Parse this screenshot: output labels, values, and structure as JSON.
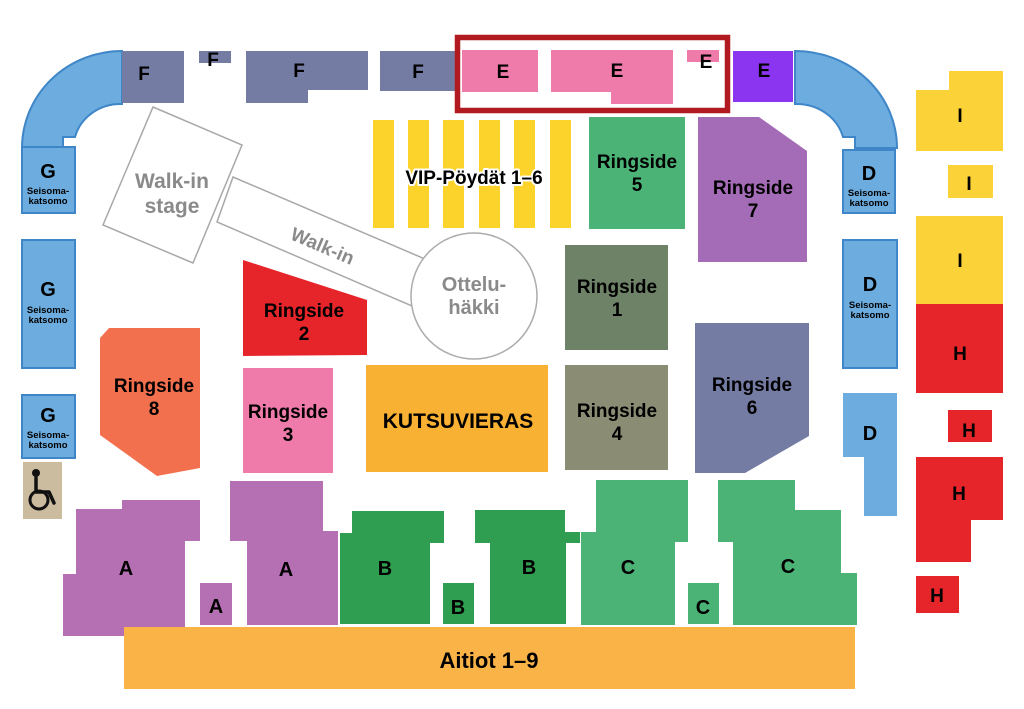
{
  "canvas": {
    "width": 1024,
    "height": 709,
    "background": "#ffffff"
  },
  "palette": {
    "standing_blue": "#6CACDE",
    "standing_blue_border": "#3E86C8",
    "slate": "#757CA4",
    "pink": "#EE7BA9",
    "violet": "#8B35F0",
    "yellow": "#FBD237",
    "vip_yellow": "#FBD32B",
    "jade": "#4CB377",
    "mauve": "#A46CB7",
    "orchid": "#B470B2",
    "red": "#E6252B",
    "coral": "#F3704E",
    "sage_dark": "#6E8268",
    "sage_grey": "#8A8C73",
    "orange": "#F8B133",
    "orange_light": "#FAB347",
    "green_dark": "#2F9E50",
    "tan": "#CBBC9F",
    "highlight_red": "#B11A21",
    "floor_grey": "#A8A8A8",
    "floor_text": "#8A8A8A"
  },
  "floor": [
    {
      "name": "walkin-corridor",
      "type": "polygon",
      "points": "233,177 432,262 419,309 217,222",
      "fill": "#ffffff",
      "stroke": "#A8A8A8",
      "stroke_width": 1.5,
      "interactable": false,
      "labels": [
        {
          "text": "Walk-in",
          "x": 320,
          "y": 252,
          "size": 19,
          "color": "#8A8A8A",
          "rotate": 23
        }
      ]
    },
    {
      "name": "walkin-stage",
      "type": "polygon",
      "points": "153,107 242,145 193,263 103,225",
      "fill": "#ffffff",
      "stroke": "#A8A8A8",
      "stroke_width": 1.5,
      "interactable": false,
      "labels": [
        {
          "lines": [
            "Walk-in",
            "stage"
          ],
          "x": 172,
          "y": 188,
          "lh": 25,
          "size": 21,
          "color": "#8A8A8A"
        }
      ]
    },
    {
      "name": "ottelu-cage",
      "type": "circle",
      "cx": 474,
      "cy": 296,
      "r": 63,
      "fill": "#ffffff",
      "stroke": "#ACACAC",
      "stroke_width": 1.5,
      "interactable": false,
      "labels": [
        {
          "lines": [
            "Ottelu-",
            "häkki"
          ],
          "x": 474,
          "y": 291,
          "lh": 23,
          "size": 20,
          "color": "#8A8A8A"
        }
      ]
    }
  ],
  "vip": {
    "name": "vip-tables",
    "stripe_xs": [
      373,
      408,
      443,
      479,
      514,
      550
    ],
    "stripe_y": 120,
    "stripe_w": 21,
    "stripe_h": 108,
    "fill": "#FBD32B",
    "label": {
      "text": "VIP-Pöydät 1–6",
      "x": 474,
      "y": 184,
      "size": 19,
      "color": "#000000",
      "halo": "#ffffff"
    }
  },
  "wheelchair": {
    "name": "wheelchair-area",
    "x": 23,
    "y": 462,
    "w": 39,
    "h": 57,
    "fill": "#CBBC9F",
    "icon": "wheelchair-icon"
  },
  "highlight": {
    "name": "highlight-box-e-sections",
    "x": 457.5,
    "y": 37.5,
    "w": 270,
    "h": 73,
    "stroke": "#B11A21",
    "stroke_width": 5.5
  },
  "sections": [
    {
      "name": "arc-left",
      "type": "path",
      "d": "M 122,51 A 100,97 0 0 0 22,148 L 63,148 L 63,137 L 75,137 A 47,44 0 0 1 122,104 Z",
      "fill": "#6CACDE",
      "stroke": "#3E86C8",
      "stroke_width": 2,
      "interactable": true,
      "labels": []
    },
    {
      "name": "arc-right",
      "type": "path",
      "d": "M 795,51 A 102,97 0 0 1 897,148 L 855,148 L 855,137 L 843,137 A 48,44 0 0 0 795,104 Z",
      "fill": "#6CACDE",
      "stroke": "#3E86C8",
      "stroke_width": 2,
      "interactable": true,
      "labels": []
    },
    {
      "name": "section-f-1",
      "type": "rect",
      "x": 122,
      "y": 51,
      "w": 62,
      "h": 52,
      "fill": "#757CA4",
      "interactable": true,
      "labels": [
        {
          "text": "F",
          "x": 144,
          "y": 80,
          "size": 19
        }
      ]
    },
    {
      "name": "section-f-2",
      "type": "rect",
      "x": 199,
      "y": 51,
      "w": 32,
      "h": 12,
      "fill": "#757CA4",
      "interactable": true,
      "labels": [
        {
          "text": "F",
          "x": 213,
          "y": 66,
          "size": 19
        }
      ]
    },
    {
      "name": "section-f-3",
      "type": "polygon",
      "points": "246,51 368,51 368,90 308,90 308,103 246,103",
      "fill": "#757CA4",
      "interactable": true,
      "labels": [
        {
          "text": "F",
          "x": 299,
          "y": 77,
          "size": 19
        }
      ]
    },
    {
      "name": "section-f-4",
      "type": "rect",
      "x": 380,
      "y": 51,
      "w": 77,
      "h": 40,
      "fill": "#757CA4",
      "interactable": true,
      "labels": [
        {
          "text": "F",
          "x": 418,
          "y": 78,
          "size": 19
        }
      ]
    },
    {
      "name": "section-e-1",
      "type": "rect",
      "x": 462,
      "y": 50,
      "w": 76,
      "h": 42,
      "fill": "#EE7BA9",
      "interactable": true,
      "labels": [
        {
          "text": "E",
          "x": 503,
          "y": 78,
          "size": 19
        }
      ]
    },
    {
      "name": "section-e-2",
      "type": "polygon",
      "points": "551,50 673,50 673,104 611,104 611,92 551,92",
      "fill": "#EE7BA9",
      "interactable": true,
      "labels": [
        {
          "text": "E",
          "x": 617,
          "y": 77,
          "size": 19
        }
      ]
    },
    {
      "name": "section-e-3",
      "type": "rect",
      "x": 687,
      "y": 50,
      "w": 32,
      "h": 12,
      "fill": "#EE7BA9",
      "interactable": true,
      "labels": [
        {
          "text": "E",
          "x": 706,
          "y": 68,
          "size": 19
        }
      ]
    },
    {
      "name": "section-e-4",
      "type": "rect",
      "x": 733,
      "y": 51,
      "w": 60,
      "h": 51,
      "fill": "#8B35F0",
      "interactable": true,
      "labels": [
        {
          "text": "E",
          "x": 764,
          "y": 77,
          "size": 19
        }
      ]
    },
    {
      "name": "section-g-1",
      "type": "rect",
      "x": 22,
      "y": 147,
      "w": 53,
      "h": 66,
      "fill": "#6CACDE",
      "stroke": "#3E86C8",
      "stroke_width": 2,
      "interactable": true,
      "labels": [
        {
          "text": "G",
          "x": 48,
          "y": 178,
          "size": 20
        },
        {
          "lines": [
            "Seisoma-",
            "katsomo"
          ],
          "x": 48,
          "y": 194,
          "lh": 10,
          "size": 9.5
        }
      ]
    },
    {
      "name": "section-g-2",
      "type": "rect",
      "x": 22,
      "y": 240,
      "w": 53,
      "h": 128,
      "fill": "#6CACDE",
      "stroke": "#3E86C8",
      "stroke_width": 2,
      "interactable": true,
      "labels": [
        {
          "text": "G",
          "x": 48,
          "y": 296,
          "size": 20
        },
        {
          "lines": [
            "Seisoma-",
            "katsomo"
          ],
          "x": 48,
          "y": 313,
          "lh": 10,
          "size": 9.5
        }
      ]
    },
    {
      "name": "section-g-3",
      "type": "rect",
      "x": 22,
      "y": 395,
      "w": 53,
      "h": 63,
      "fill": "#6CACDE",
      "stroke": "#3E86C8",
      "stroke_width": 2,
      "interactable": true,
      "labels": [
        {
          "text": "G",
          "x": 48,
          "y": 422,
          "size": 20
        },
        {
          "lines": [
            "Seisoma-",
            "katsomo"
          ],
          "x": 48,
          "y": 438,
          "lh": 10,
          "size": 9.5
        }
      ]
    },
    {
      "name": "section-d-1",
      "type": "rect",
      "x": 843,
      "y": 150,
      "w": 52,
      "h": 63,
      "fill": "#6CACDE",
      "stroke": "#3E86C8",
      "stroke_width": 2,
      "interactable": true,
      "labels": [
        {
          "text": "D",
          "x": 869,
          "y": 180,
          "size": 20
        },
        {
          "lines": [
            "Seisoma-",
            "katsomo"
          ],
          "x": 869,
          "y": 196,
          "lh": 10,
          "size": 9.5
        }
      ]
    },
    {
      "name": "section-d-2",
      "type": "rect",
      "x": 843,
      "y": 240,
      "w": 54,
      "h": 128,
      "fill": "#6CACDE",
      "stroke": "#3E86C8",
      "stroke_width": 2,
      "interactable": true,
      "labels": [
        {
          "text": "D",
          "x": 870,
          "y": 291,
          "size": 20
        },
        {
          "lines": [
            "Seisoma-",
            "katsomo"
          ],
          "x": 870,
          "y": 308,
          "lh": 10,
          "size": 9.5
        }
      ]
    },
    {
      "name": "section-d-3",
      "type": "polygon",
      "points": "843,393 897,393 897,516 864,516 864,457 843,457",
      "fill": "#6CACDE",
      "interactable": true,
      "labels": [
        {
          "text": "D",
          "x": 870,
          "y": 440,
          "size": 20
        }
      ]
    },
    {
      "name": "section-i-1",
      "type": "polygon",
      "points": "916,90 949,90 949,71 1003,71 1003,151 916,151",
      "fill": "#FBD237",
      "interactable": true,
      "labels": [
        {
          "text": "I",
          "x": 960,
          "y": 122,
          "size": 19
        }
      ]
    },
    {
      "name": "section-i-2",
      "type": "rect",
      "x": 948,
      "y": 165,
      "w": 45,
      "h": 33,
      "fill": "#FBD237",
      "interactable": true,
      "labels": [
        {
          "text": "I",
          "x": 969,
          "y": 190,
          "size": 19
        }
      ]
    },
    {
      "name": "section-i-3",
      "type": "rect",
      "x": 916,
      "y": 216,
      "w": 87,
      "h": 88,
      "fill": "#FBD237",
      "interactable": true,
      "labels": [
        {
          "text": "I",
          "x": 960,
          "y": 267,
          "size": 19
        }
      ]
    },
    {
      "name": "section-h-1",
      "type": "rect",
      "x": 916,
      "y": 304,
      "w": 87,
      "h": 89,
      "fill": "#E6252B",
      "interactable": true,
      "labels": [
        {
          "text": "H",
          "x": 960,
          "y": 360,
          "size": 19
        }
      ]
    },
    {
      "name": "section-h-2",
      "type": "rect",
      "x": 948,
      "y": 410,
      "w": 44,
      "h": 32,
      "fill": "#E6252B",
      "interactable": true,
      "labels": [
        {
          "text": "H",
          "x": 969,
          "y": 437,
          "size": 19
        }
      ]
    },
    {
      "name": "section-h-3",
      "type": "polygon",
      "points": "916,457 1003,457 1003,520 971,520 971,562 916,562",
      "fill": "#E6252B",
      "interactable": true,
      "labels": [
        {
          "text": "H",
          "x": 959,
          "y": 500,
          "size": 19
        }
      ]
    },
    {
      "name": "section-h-4",
      "type": "rect",
      "x": 916,
      "y": 576,
      "w": 43,
      "h": 37,
      "fill": "#E6252B",
      "interactable": true,
      "labels": [
        {
          "text": "H",
          "x": 937,
          "y": 602,
          "size": 19
        }
      ]
    },
    {
      "name": "section-ringside-5",
      "type": "rect",
      "x": 589,
      "y": 117,
      "w": 96,
      "h": 112,
      "fill": "#4CB377",
      "interactable": true,
      "labels": [
        {
          "lines": [
            "Ringside",
            "5"
          ],
          "x": 637,
          "y": 168,
          "lh": 23,
          "size": 19
        }
      ]
    },
    {
      "name": "section-ringside-7",
      "type": "polygon",
      "points": "698,117 759,117 807,151 807,262 698,262",
      "fill": "#A46CB7",
      "interactable": true,
      "labels": [
        {
          "lines": [
            "Ringside",
            "7"
          ],
          "x": 753,
          "y": 194,
          "lh": 23,
          "size": 19
        }
      ]
    },
    {
      "name": "section-ringside-1",
      "type": "rect",
      "x": 565,
      "y": 245,
      "w": 103,
      "h": 105,
      "fill": "#6E8268",
      "interactable": true,
      "labels": [
        {
          "lines": [
            "Ringside",
            "1"
          ],
          "x": 617,
          "y": 293,
          "lh": 23,
          "size": 19
        }
      ]
    },
    {
      "name": "section-ringside-2",
      "type": "polygon",
      "points": "243,260 367,300 367,355 243,356",
      "fill": "#E6252B",
      "interactable": true,
      "labels": [
        {
          "lines": [
            "Ringside",
            "2"
          ],
          "x": 304,
          "y": 317,
          "lh": 23,
          "size": 19
        }
      ]
    },
    {
      "name": "section-ringside-3",
      "type": "rect",
      "x": 243,
      "y": 368,
      "w": 90,
      "h": 105,
      "fill": "#EE7BA9",
      "interactable": true,
      "labels": [
        {
          "lines": [
            "Ringside",
            "3"
          ],
          "x": 288,
          "y": 418,
          "lh": 23,
          "size": 19
        }
      ]
    },
    {
      "name": "section-ringside-8",
      "type": "polygon",
      "points": "109,328 200,328 200,468 157,476 100,435 100,338",
      "fill": "#F3704E",
      "interactable": true,
      "labels": [
        {
          "lines": [
            "Ringside",
            "8"
          ],
          "x": 154,
          "y": 392,
          "lh": 23,
          "size": 19
        }
      ]
    },
    {
      "name": "section-ringside-6",
      "type": "polygon",
      "points": "695,323 809,323 809,436 745,473 695,473",
      "fill": "#757CA4",
      "interactable": true,
      "labels": [
        {
          "lines": [
            "Ringside",
            "6"
          ],
          "x": 752,
          "y": 391,
          "lh": 23,
          "size": 19
        }
      ]
    },
    {
      "name": "section-ringside-4",
      "type": "rect",
      "x": 565,
      "y": 365,
      "w": 103,
      "h": 105,
      "fill": "#8A8C73",
      "interactable": true,
      "labels": [
        {
          "lines": [
            "Ringside",
            "4"
          ],
          "x": 617,
          "y": 417,
          "lh": 23,
          "size": 19
        }
      ]
    },
    {
      "name": "section-kutsuvieras",
      "type": "rect",
      "x": 366,
      "y": 365,
      "w": 182,
      "h": 107,
      "fill": "#F8B133",
      "interactable": true,
      "labels": [
        {
          "text": "KUTSUVIERAS",
          "x": 458,
          "y": 428,
          "size": 21
        }
      ]
    },
    {
      "name": "section-a-1",
      "type": "polygon",
      "points": "76,509 122,509 122,500 200,500 200,541 185,541 185,628 124,628 124,636 63,636 63,574 76,574",
      "fill": "#B470B2",
      "interactable": true,
      "labels": [
        {
          "text": "A",
          "x": 126,
          "y": 575,
          "size": 20
        }
      ]
    },
    {
      "name": "section-a-2",
      "type": "rect",
      "x": 200,
      "y": 583,
      "w": 32,
      "h": 42,
      "fill": "#B470B2",
      "interactable": true,
      "labels": [
        {
          "text": "A",
          "x": 216,
          "y": 613,
          "size": 20
        }
      ]
    },
    {
      "name": "section-a-3",
      "type": "polygon",
      "points": "230,481 323,481 323,531 338,531 338,625 247,625 247,541 230,541",
      "fill": "#B470B2",
      "interactable": true,
      "labels": [
        {
          "text": "A",
          "x": 286,
          "y": 576,
          "size": 20
        }
      ]
    },
    {
      "name": "section-b-1",
      "type": "polygon",
      "points": "340,533 352,533 352,511 444,511 444,543 430,543 430,624 340,624",
      "fill": "#2F9E50",
      "interactable": true,
      "labels": [
        {
          "text": "B",
          "x": 385,
          "y": 575,
          "size": 20
        }
      ]
    },
    {
      "name": "section-b-2",
      "type": "rect",
      "x": 443,
      "y": 583,
      "w": 31,
      "h": 41,
      "fill": "#2F9E50",
      "interactable": true,
      "labels": [
        {
          "text": "B",
          "x": 458,
          "y": 614,
          "size": 20
        }
      ]
    },
    {
      "name": "section-b-3",
      "type": "polygon",
      "points": "475,510 565,510 565,532 580,532 580,543 566,543 566,624 490,624 490,543 475,543",
      "fill": "#2F9E50",
      "interactable": true,
      "labels": [
        {
          "text": "B",
          "x": 529,
          "y": 574,
          "size": 20
        }
      ]
    },
    {
      "name": "section-c-1",
      "type": "polygon",
      "points": "596,480 688,480 688,542 675,542 675,625 581,625 581,532 596,532",
      "fill": "#4CB377",
      "interactable": true,
      "labels": [
        {
          "text": "C",
          "x": 628,
          "y": 574,
          "size": 20
        }
      ]
    },
    {
      "name": "section-c-2",
      "type": "rect",
      "x": 688,
      "y": 583,
      "w": 31,
      "h": 41,
      "fill": "#4CB377",
      "interactable": true,
      "labels": [
        {
          "text": "C",
          "x": 703,
          "y": 614,
          "size": 20
        }
      ]
    },
    {
      "name": "section-c-3",
      "type": "polygon",
      "points": "718,480 795,480 795,510 841,510 841,573 857,573 857,625 733,625 733,542 718,542",
      "fill": "#4CB377",
      "interactable": true,
      "labels": [
        {
          "text": "C",
          "x": 788,
          "y": 573,
          "size": 20
        }
      ]
    },
    {
      "name": "section-aitiot",
      "type": "rect",
      "x": 124,
      "y": 627,
      "w": 731,
      "h": 62,
      "fill": "#FAB347",
      "interactable": true,
      "labels": [
        {
          "text": "Aitiot 1–9",
          "x": 489,
          "y": 668,
          "size": 22
        }
      ]
    }
  ]
}
